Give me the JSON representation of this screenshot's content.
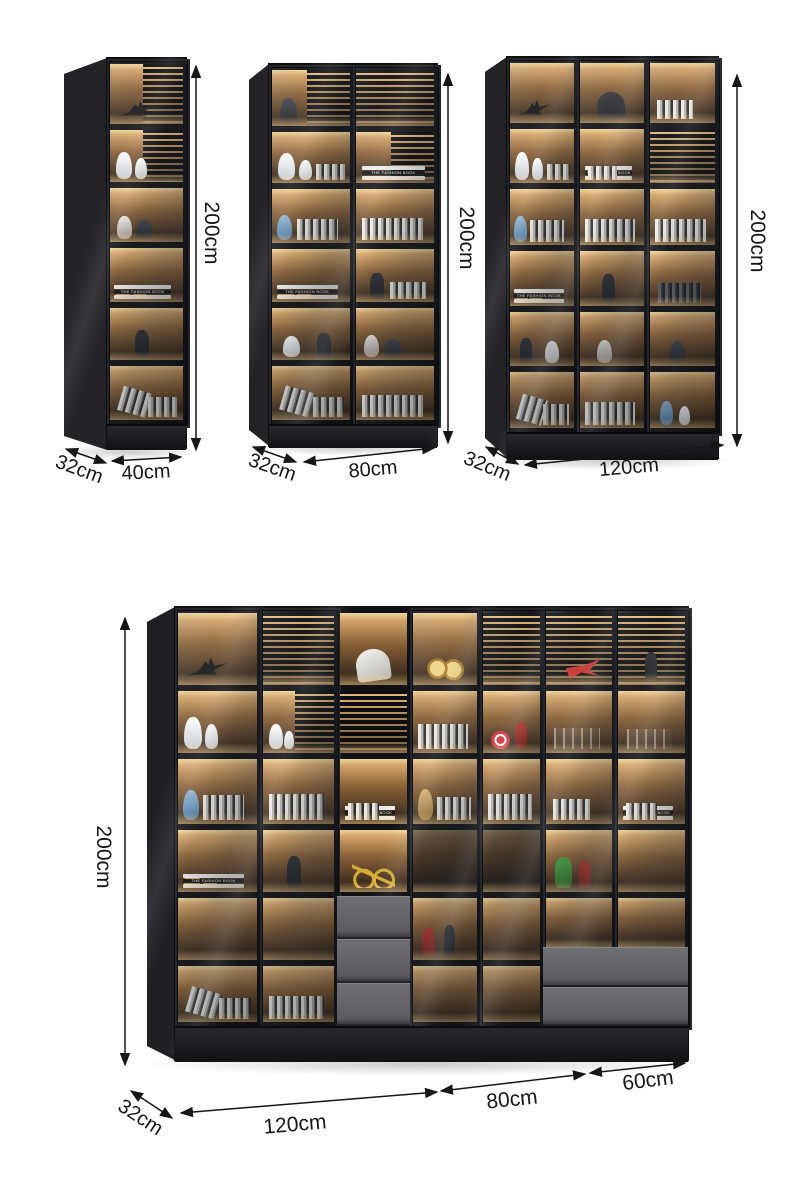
{
  "annotations": {
    "cabinet_40": {
      "height": "200cm",
      "depth": "32cm",
      "width": "40cm"
    },
    "cabinet_80": {
      "height": "200cm",
      "depth": "32cm",
      "width": "80cm"
    },
    "cabinet_120": {
      "height": "200cm",
      "depth": "32cm",
      "width": "120cm"
    },
    "cabinet_combo": {
      "height": "200cm",
      "depth": "32cm",
      "width_left": "120cm",
      "width_middle": "80cm",
      "width_right": "60cm"
    }
  },
  "decor": {
    "book_title": "THE FASHION BOOK"
  },
  "colors": {
    "annotation": "#161616",
    "cabinet_frame": "#17181b",
    "warm_light": "#d3a468",
    "drawer_front": "#63656a",
    "background": "#ffffff"
  }
}
